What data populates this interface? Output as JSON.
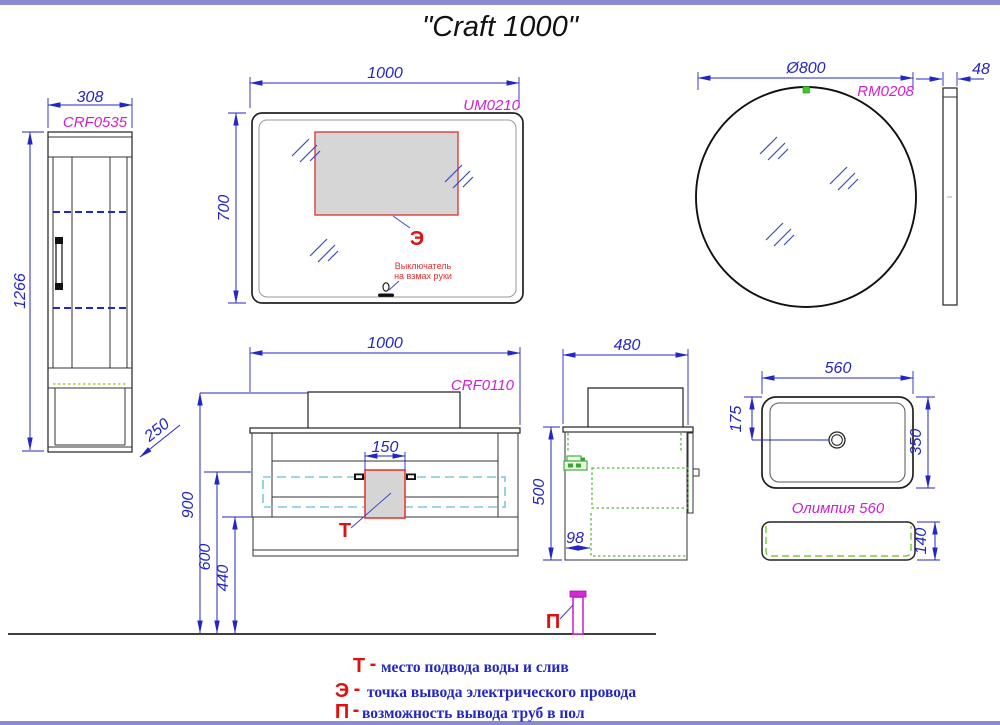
{
  "page": {
    "title": "\"Craft 1000\"",
    "border_color": "#8a8ad0"
  },
  "cabinet": {
    "label": "CRF0535",
    "width": "308",
    "height": "1266",
    "depth": "250"
  },
  "mirror": {
    "label": "UM0210",
    "width": "1000",
    "height": "700",
    "marker": "Э",
    "note1": "Выключатель",
    "note2": "на взмах руки"
  },
  "round_mirror": {
    "label": "RM0208",
    "diameter": "Ø800",
    "depth": "48"
  },
  "vanity": {
    "label": "CRF0110",
    "width": "1000",
    "drain_width": "150",
    "marker": "Т",
    "h900": "900",
    "h600": "600",
    "h440": "440"
  },
  "vanity_side": {
    "depth": "480",
    "height": "500",
    "offset": "98"
  },
  "floor": {
    "pipe_marker": "П"
  },
  "basin": {
    "label": "Олимпия 560",
    "width": "560",
    "depth": "350",
    "drain_offset": "175",
    "height": "140"
  },
  "legend": {
    "rows": [
      {
        "marker": "Т",
        "sep": "-",
        "text": "место подвода воды и слив"
      },
      {
        "marker": "Э",
        "sep": "-",
        "text": "точка вывода электрического провода"
      },
      {
        "marker": "П",
        "sep": "-",
        "text": "возможность вывода труб в пол"
      }
    ]
  }
}
